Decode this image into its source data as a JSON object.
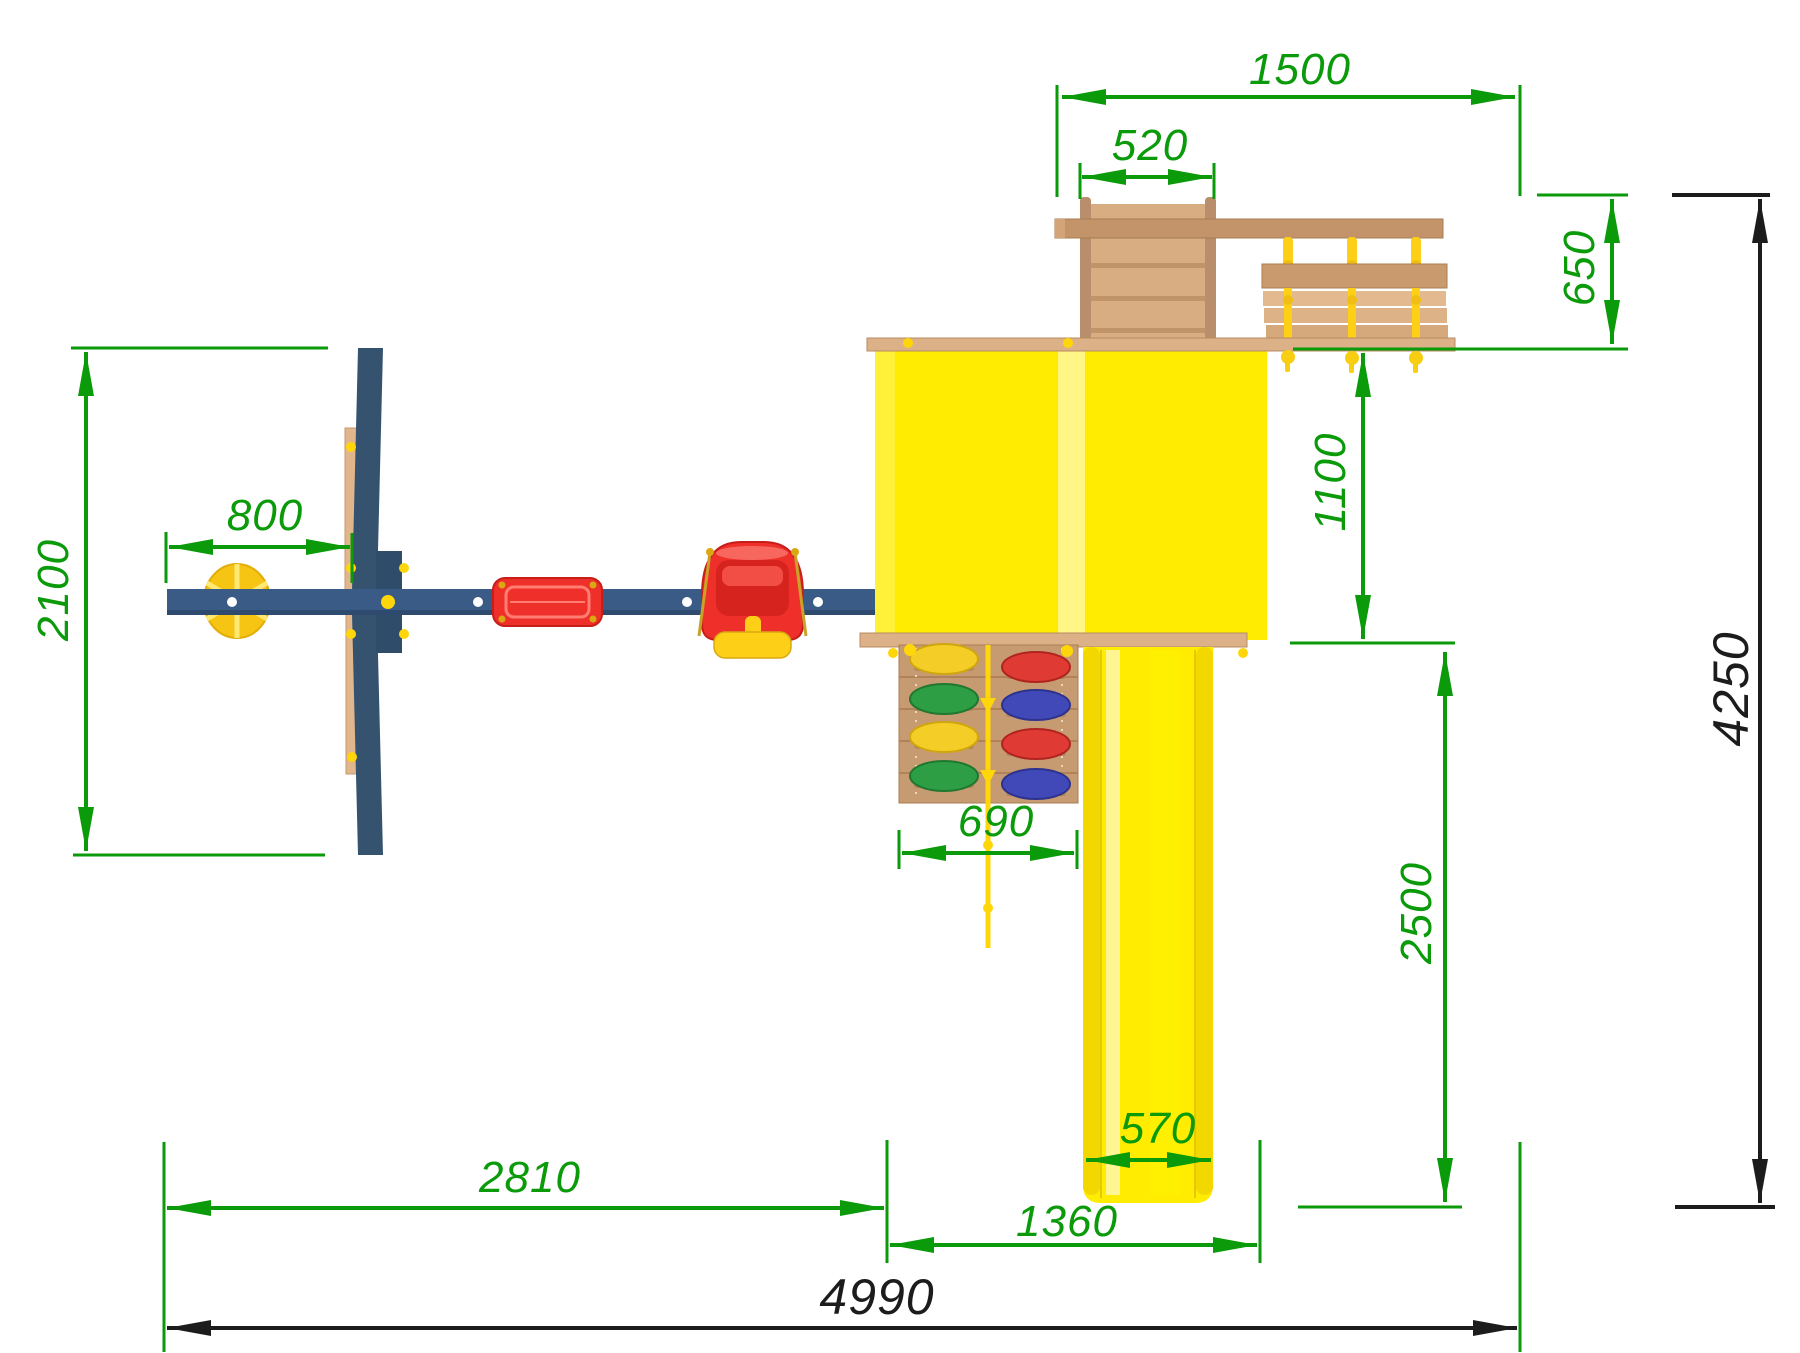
{
  "dimensions": {
    "d1500": "1500",
    "d520": "520",
    "d650": "650",
    "d1100": "1100",
    "d2500": "2500",
    "d4250": "4250",
    "d2100": "2100",
    "d800": "800",
    "d690": "690",
    "d570": "570",
    "d2810": "2810",
    "d1360": "1360",
    "d4990": "4990"
  },
  "colors": {
    "dimension_green": "#0a9a0a",
    "dimension_black": "#1c1c1c",
    "platform_yellow": "#ffec00",
    "platform_stripe": "#fff685",
    "slide_yellow": "#ffec00",
    "wood_light": "#dcb187",
    "wood_medium": "#c3946a",
    "wood_rail": "#b98e6d",
    "frame_blue": "#3a5b85",
    "leg_blue": "#35536f",
    "seat_red": "#ee2f2a",
    "rope_yellow": "#fdd017",
    "hold_yellow": "#f5cd27",
    "hold_green": "#2e9e44",
    "hold_red": "#e03a34",
    "hold_blue": "#4149b8"
  }
}
